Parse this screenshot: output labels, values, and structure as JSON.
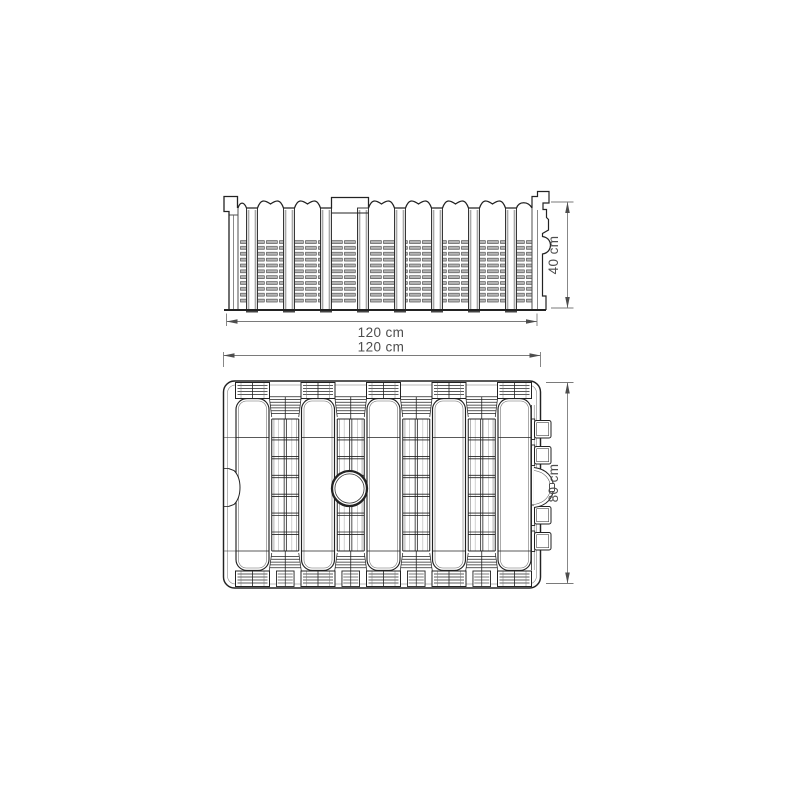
{
  "page": {
    "background": "#ffffff"
  },
  "diagram": {
    "type": "technical-drawing",
    "subject": "infiltration-module-two-views",
    "views": {
      "front": {
        "name": "front elevation",
        "width_label": "120 cm",
        "height_label": "40 cm"
      },
      "plan": {
        "name": "top plan",
        "width_label": "120 cm",
        "height_label": "80 cm"
      }
    },
    "features": {
      "front_view": [
        "wavy ribbed top edge",
        "recessed notch at top",
        "8 vertical pillars",
        "slotted vent panels",
        "stepped end connector right",
        "end tab left"
      ],
      "plan_view": [
        "5 corrugation crests",
        "4 ladder valleys",
        "central circular opening",
        "4 connector ports right",
        "half-round port right",
        "notch left edge"
      ]
    },
    "colors": {
      "line": "#222222",
      "dim_line": "#7a7a7a",
      "dim_arrow": "#4d4d4d",
      "text": "#4d4d4d",
      "slat_fill": "#b5b5b5",
      "pillar_stripe": "#a8a8a8"
    }
  }
}
